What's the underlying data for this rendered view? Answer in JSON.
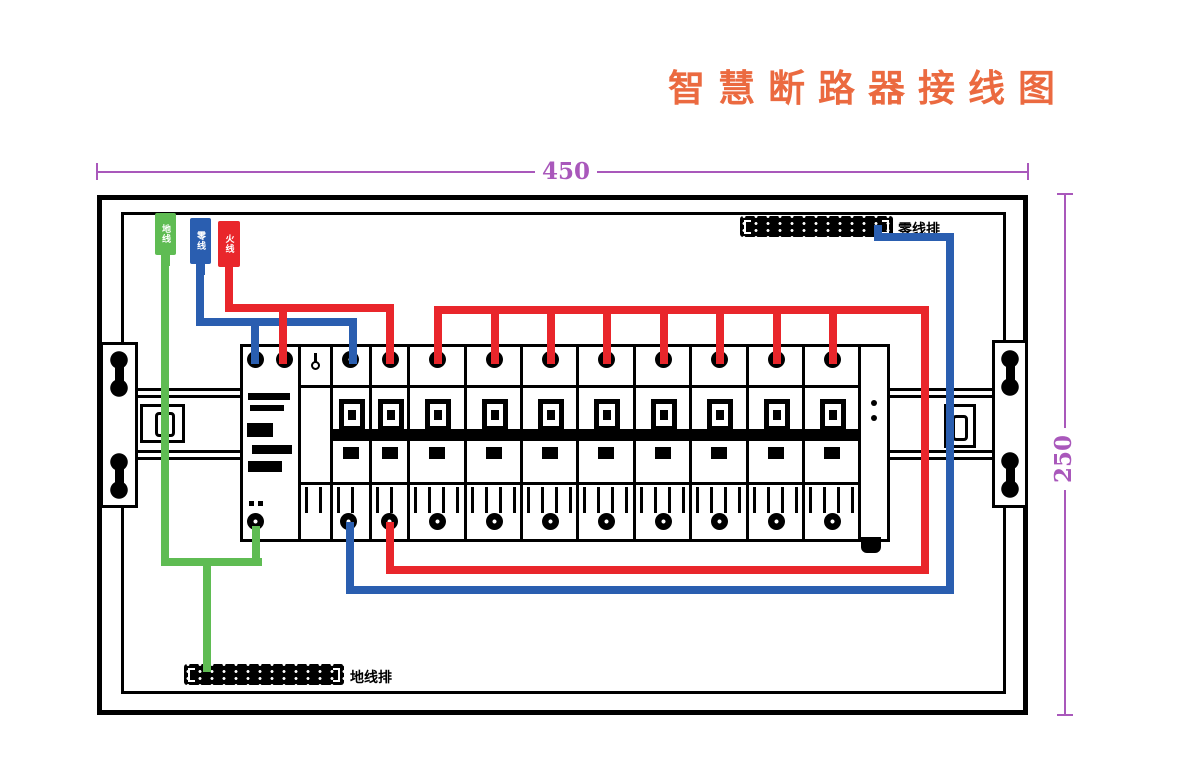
{
  "title": {
    "text": "智慧断路器接线图"
  },
  "dimensions": {
    "width": "450",
    "height": "250"
  },
  "incoming_wires": [
    {
      "name": "ground",
      "label": "地线",
      "color": "#5FBC53"
    },
    {
      "name": "neutral",
      "label": "零线",
      "color": "#2A5EB0"
    },
    {
      "name": "live",
      "label": "火线",
      "color": "#E9262B"
    }
  ],
  "terminal_bars": {
    "neutral_label": "零线排",
    "ground_label": "地线排"
  },
  "breakers": {
    "branch_count": 8,
    "main_count": 1
  },
  "colors": {
    "title": "#EB6A40",
    "dimension": "#A958BB",
    "live": "#E9262B",
    "neutral": "#2A5EB0",
    "ground": "#5FBC53"
  }
}
